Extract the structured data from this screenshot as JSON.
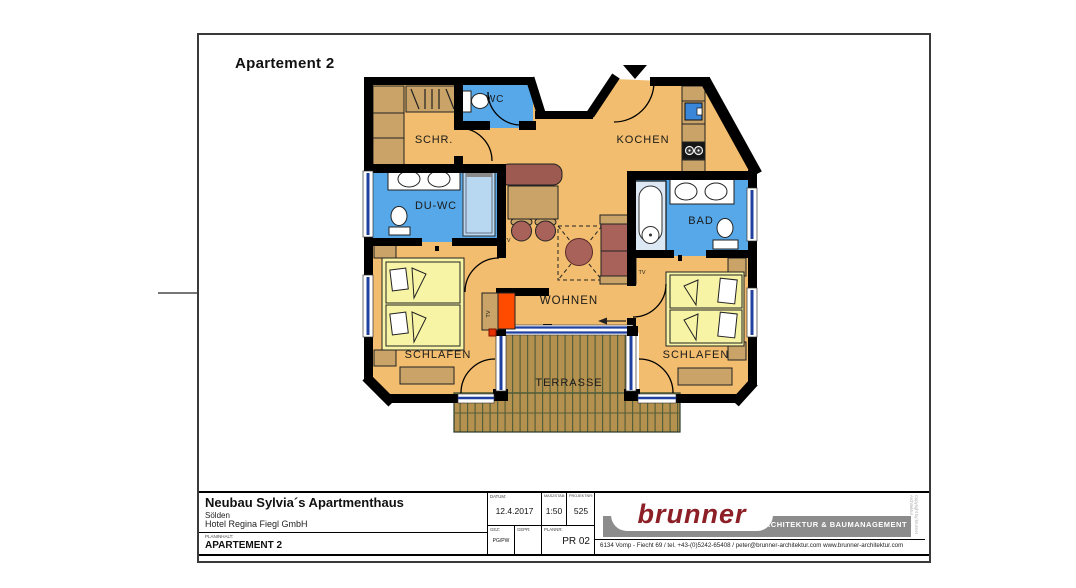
{
  "header": {
    "title": "Apartement 2"
  },
  "plan": {
    "rooms": [
      {
        "label": "WC"
      },
      {
        "label": "SCHR."
      },
      {
        "label": "KOCHEN"
      },
      {
        "label": "DU-WC"
      },
      {
        "label": "BAD"
      },
      {
        "label": "WOHNEN"
      },
      {
        "label": "SCHLAFEN"
      },
      {
        "label": "SCHLAFEN"
      },
      {
        "label": "TERRASSE"
      }
    ],
    "tv_label": "TV"
  },
  "titleblock": {
    "project_title": "Neubau Sylvia´s Apartmenthaus",
    "location": "Sölden",
    "client": "Hotel Regina Fiegl GmbH",
    "plan_content_label": "PLANINHALT:",
    "plan_content": "APARTEMENT 2",
    "datum_label": "DATUM:",
    "datum": "12.4.2017",
    "scale_label": "MASZSTAB:",
    "scale": "1:50",
    "project_no_label": "PROJEKTNR:",
    "project_no": "525",
    "gez_label": "GEZ:",
    "gez": "PG/PW",
    "gepr_label": "GEPR:",
    "plannr_label": "PLANNR:",
    "plannr": "PR 02"
  },
  "logo": {
    "brand": "brunner",
    "tagline": "ARCHITEKTUR & BAUMANAGEMENT",
    "address": "6134 Vomp - Fiecht 69 / tel. +43-(0)5242-65408 / peter@brunner-architektur.com   www.brunner-architektur.com",
    "copyright": "Copyright by brunner Architektur"
  },
  "colors": {
    "floor": "#F2BD6E",
    "wet_room": "#56A8E8",
    "shower": "#B8D8F2",
    "bed": "#F8F4A6",
    "wood_deck": "#B5914F",
    "furniture_rose": "#A8625A",
    "furniture_tan": "#C9A367",
    "window_blue": "#2040A0",
    "stove_orange": "#FF4B00",
    "logo_red": "#8C2026",
    "logo_gray": "#8C8C8C"
  }
}
